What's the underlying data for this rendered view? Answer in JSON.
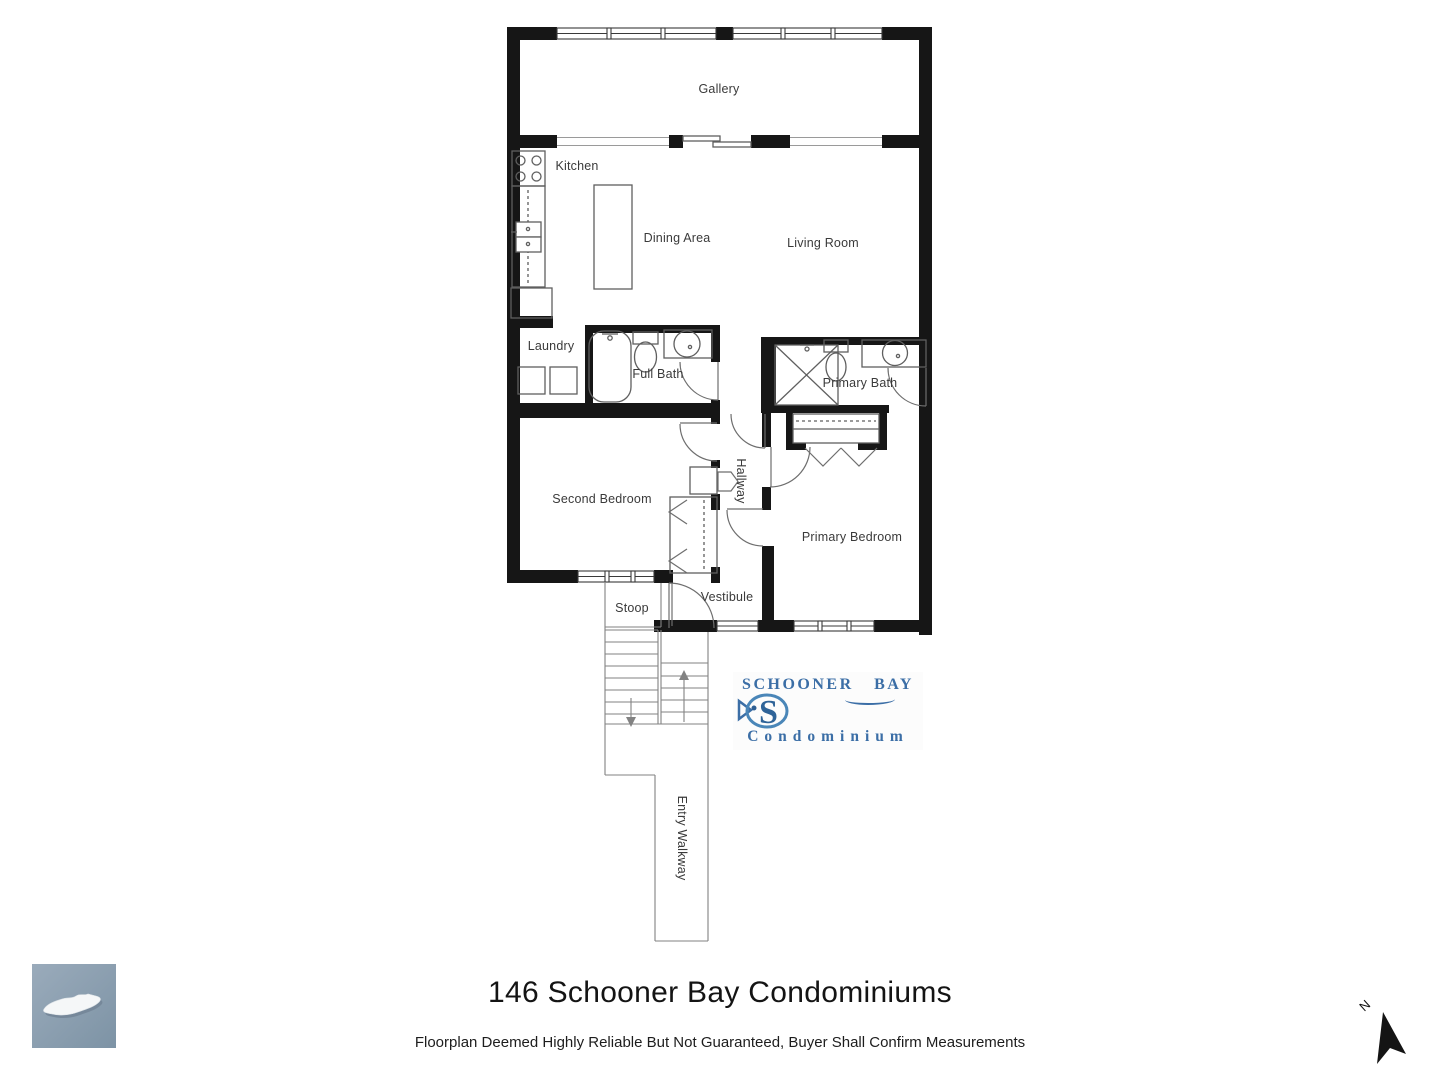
{
  "rooms": {
    "gallery": "Gallery",
    "kitchen": "Kitchen",
    "dining": "Dining Area",
    "living": "Living Room",
    "laundry": "Laundry",
    "full_bath": "Full Bath",
    "primary_bath": "Primary Bath",
    "second_bedroom": "Second Bedroom",
    "hallway": "Hallway",
    "primary_bedroom": "Primary Bedroom",
    "vestibule": "Vestibule",
    "stoop": "Stoop",
    "entry_walkway": "Entry Walkway"
  },
  "logo": {
    "line1": "SCHOONER BAY",
    "line2": "Condominium"
  },
  "title": "146 Schooner Bay Condominiums",
  "disclaimer": "Floorplan Deemed Highly Reliable But Not Guaranteed, Buyer Shall Confirm Measurements",
  "compass": {
    "label": "N"
  },
  "colors": {
    "wall": "#161616",
    "fixture": "#5f5f5f",
    "door": "#6e6e6e",
    "stair": "#828282",
    "window": "#3a3a3a",
    "label": "#3a3a3a",
    "logo_blue": "#3b6ea6",
    "island_top": "#9aabbb",
    "island_bottom": "#7d93a5"
  }
}
